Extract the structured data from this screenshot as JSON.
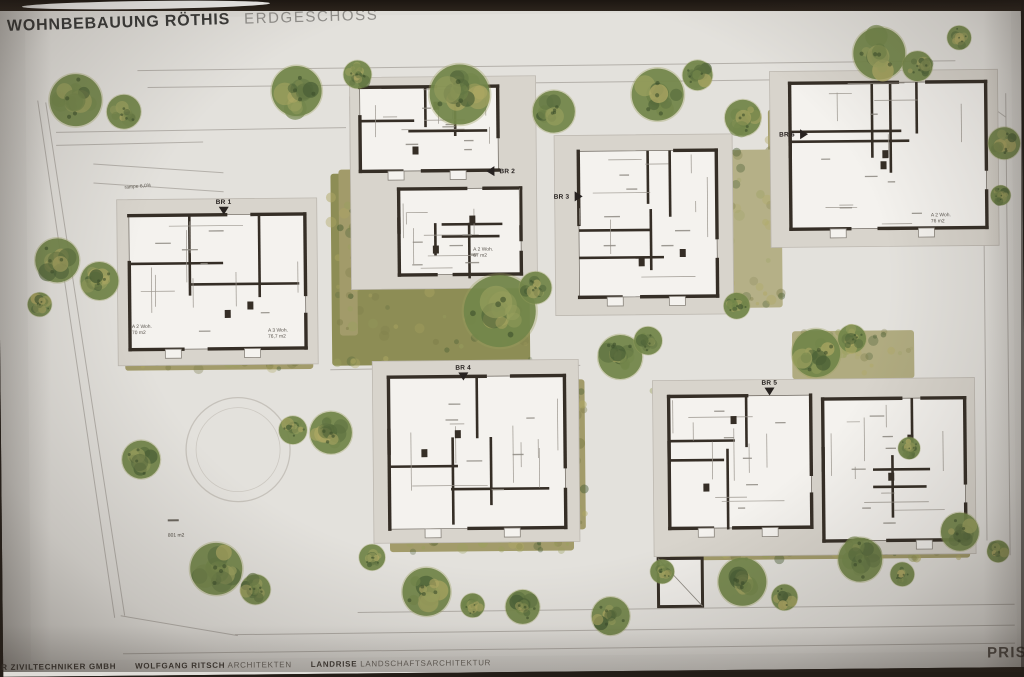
{
  "title": {
    "project": "WOHNBEBAUUNG RÖTHIS",
    "sheet": "ERDGESCHOSS"
  },
  "plan": {
    "buildings": [
      {
        "label": "BR 1",
        "entry_direction": "down"
      },
      {
        "label": "BR 2",
        "entry_direction": "left"
      },
      {
        "label": "BR 3",
        "entry_direction": "right"
      },
      {
        "label": "BR 4",
        "entry_direction": "down"
      },
      {
        "label": "BR 5",
        "entry_direction": "down"
      },
      {
        "label": "BR 6",
        "entry_direction": "right"
      }
    ],
    "annotations": {
      "ramp": "rampe 6,0%",
      "site_area": "801 m2",
      "unit_labels": [
        {
          "type": "A 2 Woh.",
          "area": "70 m2"
        },
        {
          "type": "A 3 Woh.",
          "area": "76,7 m2"
        },
        {
          "type": "A 2 Woh.",
          "area": "67 m2"
        },
        {
          "type": "A 2 Woh.",
          "area": "76 m2"
        }
      ]
    }
  },
  "footer": {
    "engineer": "ER ZIVILTECHNIKER GMBH",
    "architect_name": "WOLFGANG RITSCH",
    "architect_role": "ARCHITEKTEN",
    "landscape_name": "LANDRISE",
    "landscape_role": "LANDSCHAFTSARCHITEKTUR",
    "brand_partial": "PRISM"
  },
  "colors": {
    "paper": "#dedcd7",
    "paper_inner": "#e3e1dc",
    "wall": "#352e26",
    "meadow": "#8d8d55",
    "hedge": "#a29b6a",
    "tree_dark": "#4a5f36",
    "tree_mid": "#72854a",
    "tree_light": "#9aa05e",
    "tree_yellow": "#b0a964",
    "line": "#b4b0aa",
    "plinth": "#d8d4cc"
  }
}
